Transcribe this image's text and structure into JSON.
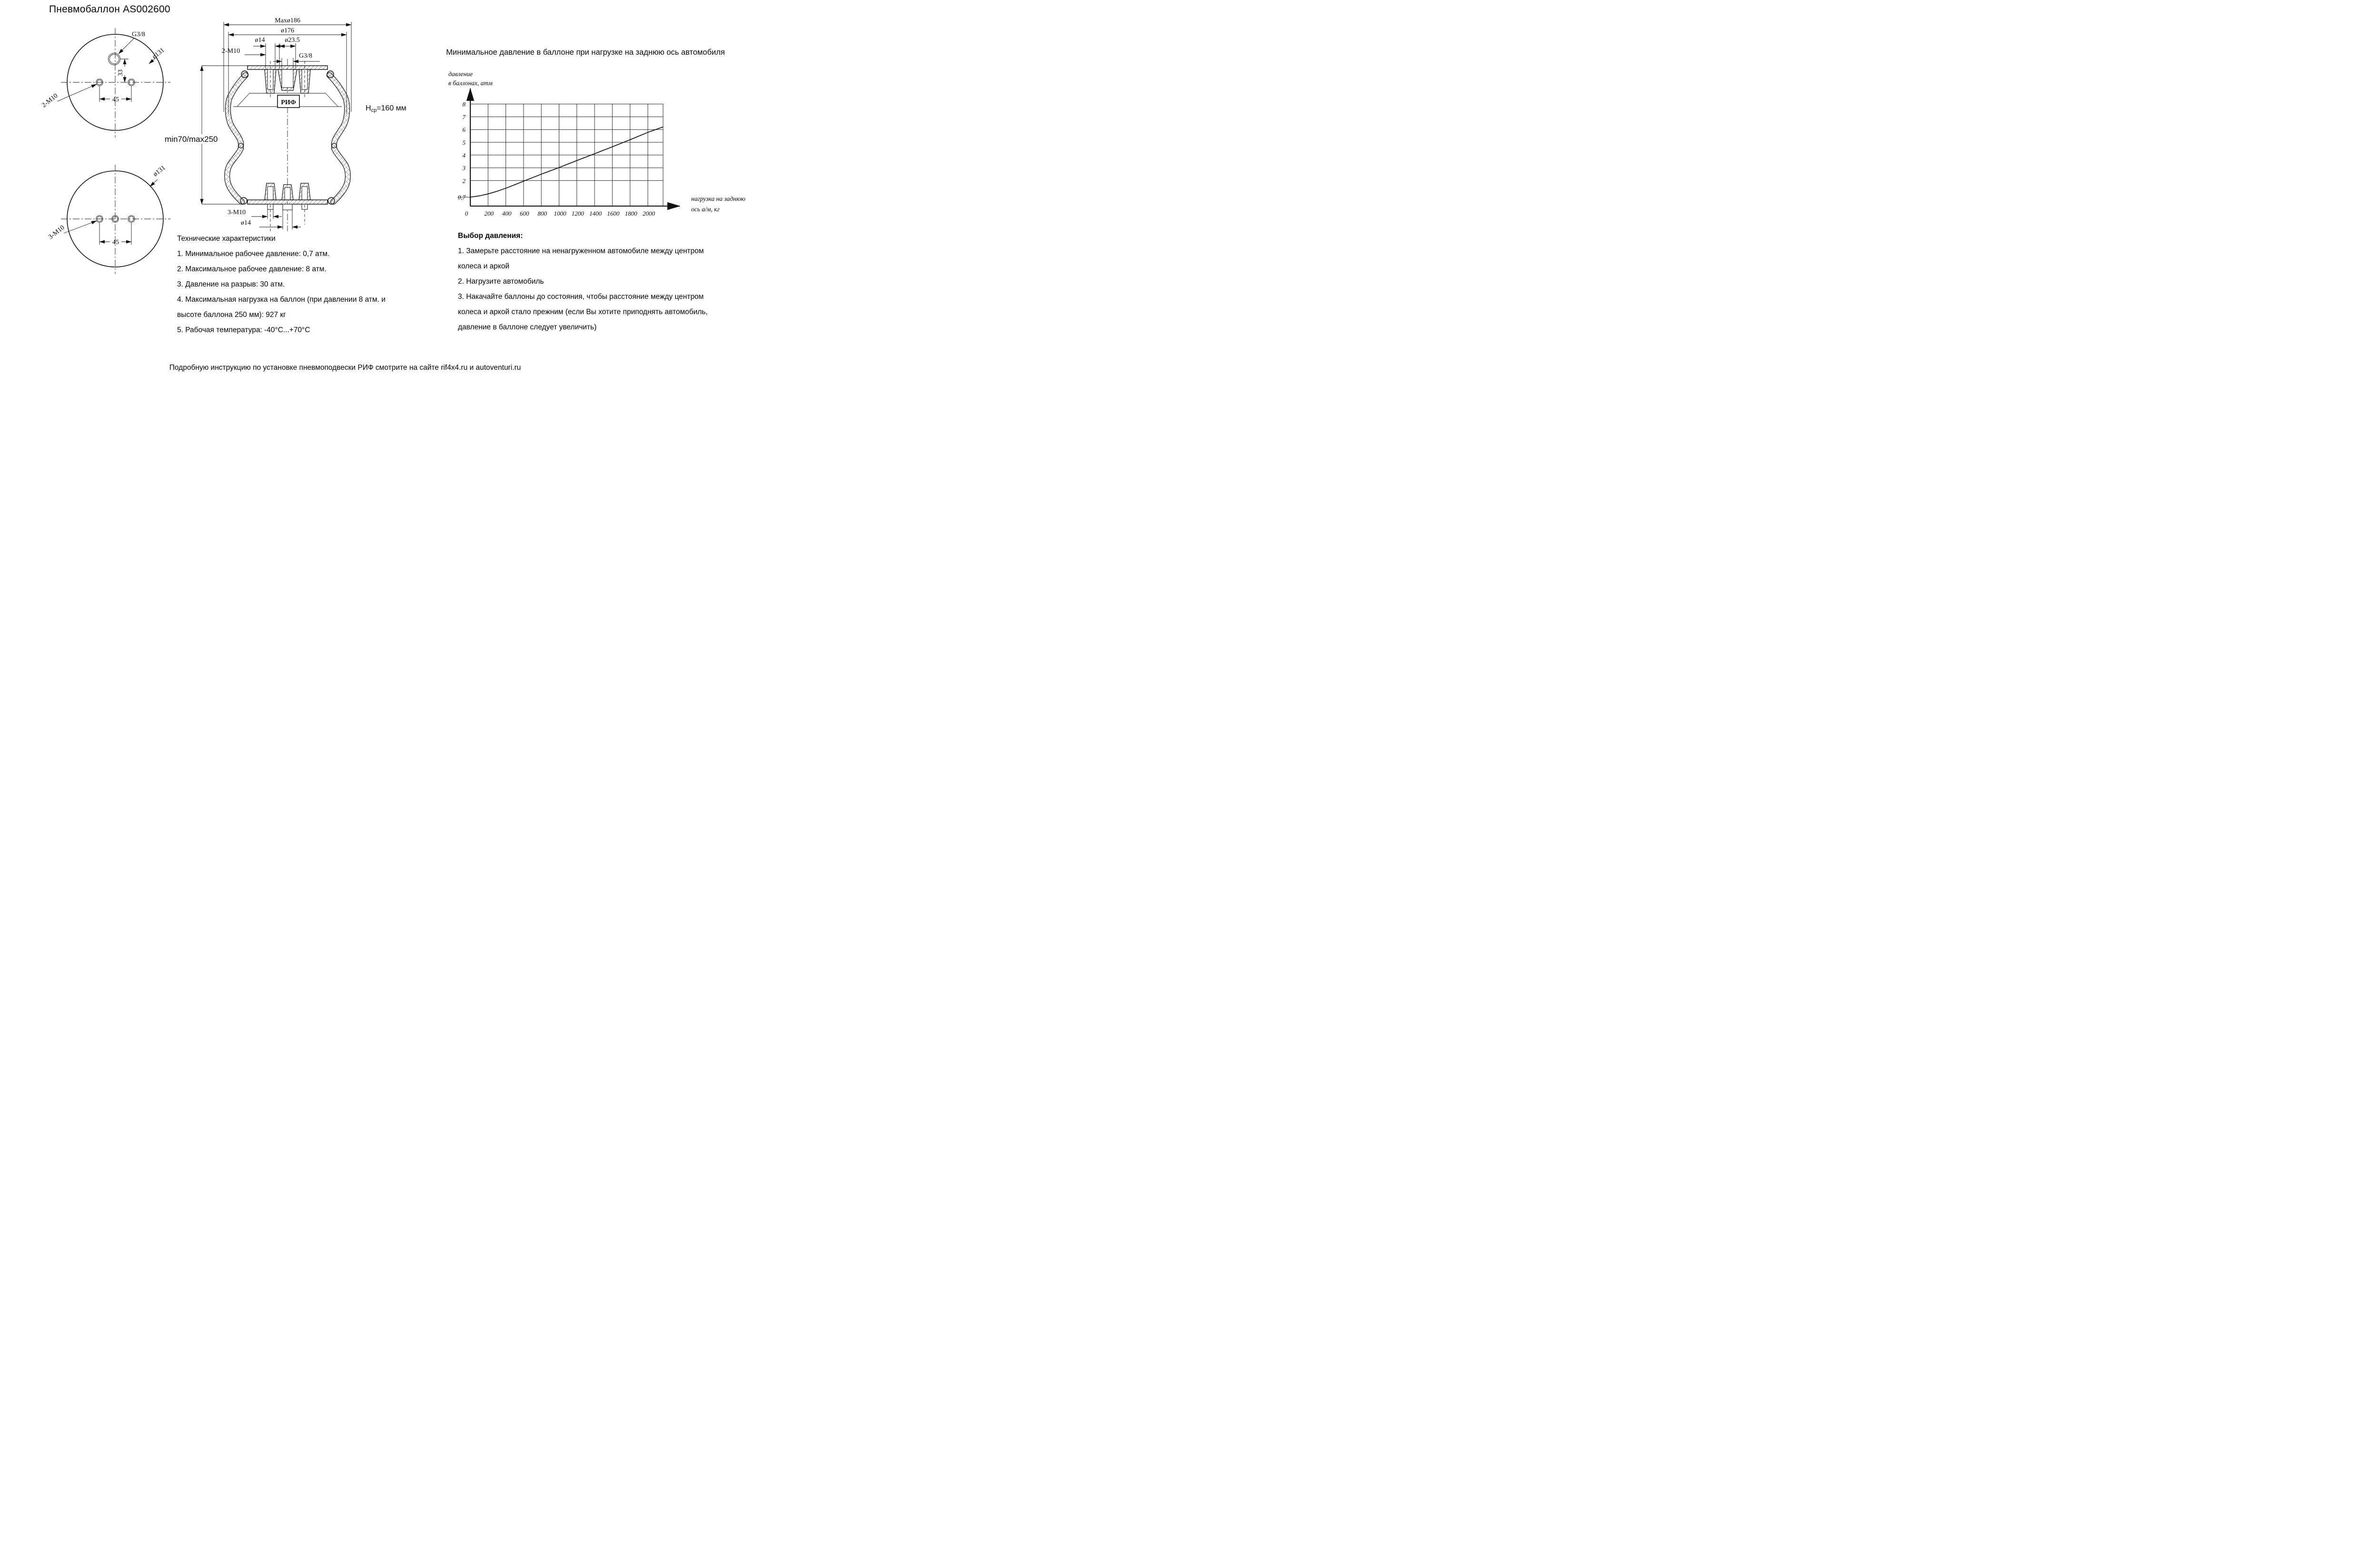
{
  "title": "Пневмобаллон  AS002600",
  "drawing": {
    "top_view": {
      "port": "G3/8",
      "diameter": "ø131",
      "studs": "2-M10",
      "dim_vertical": "33",
      "dim_horizontal": "45"
    },
    "bottom_view": {
      "diameter": "ø131",
      "studs": "3-M10",
      "dim_horizontal": "45"
    },
    "section_view": {
      "dim_max_diameter": "Maxø186",
      "dim_outer_diameter": "ø176",
      "dim_stud_top": "ø14",
      "dim_port_boss": "ø23.5",
      "studs_top": "2-M10",
      "port": "G3/8",
      "brand": "РИФ",
      "height_main": "Н",
      "height_sub": "ср",
      "height_rest": "=160 мм",
      "travel_range": "min70/max250",
      "studs_bottom": "3-M10",
      "dim_stud_bottom": "ø14"
    }
  },
  "chart": {
    "title": "Минимальное давление в баллоне при нагрузке на заднюю ось автомобиля",
    "y_label_line1": "давление",
    "y_label_line2": "в баллонах, атм",
    "x_label_line1": "нагрузка на заднюю",
    "x_label_line2": "ось а/м, кг"
  },
  "chart_data": {
    "type": "line",
    "title": "Минимальное давление в баллоне при нагрузке на заднюю ось автомобиля",
    "xlabel": "нагрузка на заднюю ось а/м, кг",
    "ylabel": "давление в баллонах, атм",
    "xlim": [
      0,
      2170
    ],
    "ylim": [
      0,
      8.6
    ],
    "grid": true,
    "x_ticks": [
      0,
      200,
      400,
      600,
      800,
      1000,
      1200,
      1400,
      1600,
      1800,
      2000
    ],
    "y_grid": [
      2,
      3,
      4,
      5,
      6,
      7,
      8
    ],
    "y_tick_labels": [
      {
        "v": 8,
        "t": "8"
      },
      {
        "v": 7,
        "t": "7"
      },
      {
        "v": 6,
        "t": "6"
      },
      {
        "v": 5,
        "t": "5"
      },
      {
        "v": 4,
        "t": "4"
      },
      {
        "v": 3,
        "t": "3"
      },
      {
        "v": 2,
        "t": "2"
      },
      {
        "v": 0.7,
        "t": "0,7"
      }
    ],
    "curve": [
      [
        0,
        0.7
      ],
      [
        100,
        0.8
      ],
      [
        200,
        0.95
      ],
      [
        300,
        1.16
      ],
      [
        400,
        1.4
      ],
      [
        500,
        1.67
      ],
      [
        600,
        1.95
      ],
      [
        800,
        2.5
      ],
      [
        1000,
        3.02
      ],
      [
        1200,
        3.57
      ],
      [
        1400,
        4.1
      ],
      [
        1600,
        4.65
      ],
      [
        1800,
        5.2
      ],
      [
        2000,
        5.78
      ],
      [
        2170,
        6.2
      ]
    ]
  },
  "specs": {
    "heading": "Технические характеристики",
    "lines": [
      "1. Минимальное рабочее давление: 0,7 атм.",
      "2. Максимальное рабочее давление: 8 атм.",
      "3. Давление на разрыв: 30 атм.",
      "4. Максимальная нагрузка на баллон (при давлении 8 атм. и",
      "высоте баллона 250 мм): 927 кг",
      "5. Рабочая температура: -40°С...+70°С"
    ]
  },
  "pressure_selection": {
    "heading": "Выбор давления:",
    "lines": [
      "1. Замерьте расстояние на ненагруженном автомобиле между центром",
      "колеса и аркой",
      "2. Нагрузите автомобиль",
      "3. Накачайте баллоны до состояния, чтобы расстояние между центром",
      "колеса и аркой стало прежним (если Вы хотите приподнять автомобиль,",
      "давление в баллоне следует увеличить)"
    ]
  },
  "footer": "Подробную инструкцию по установке пневмоподвески РИФ смотрите на сайте rif4x4.ru и autoventuri.ru"
}
